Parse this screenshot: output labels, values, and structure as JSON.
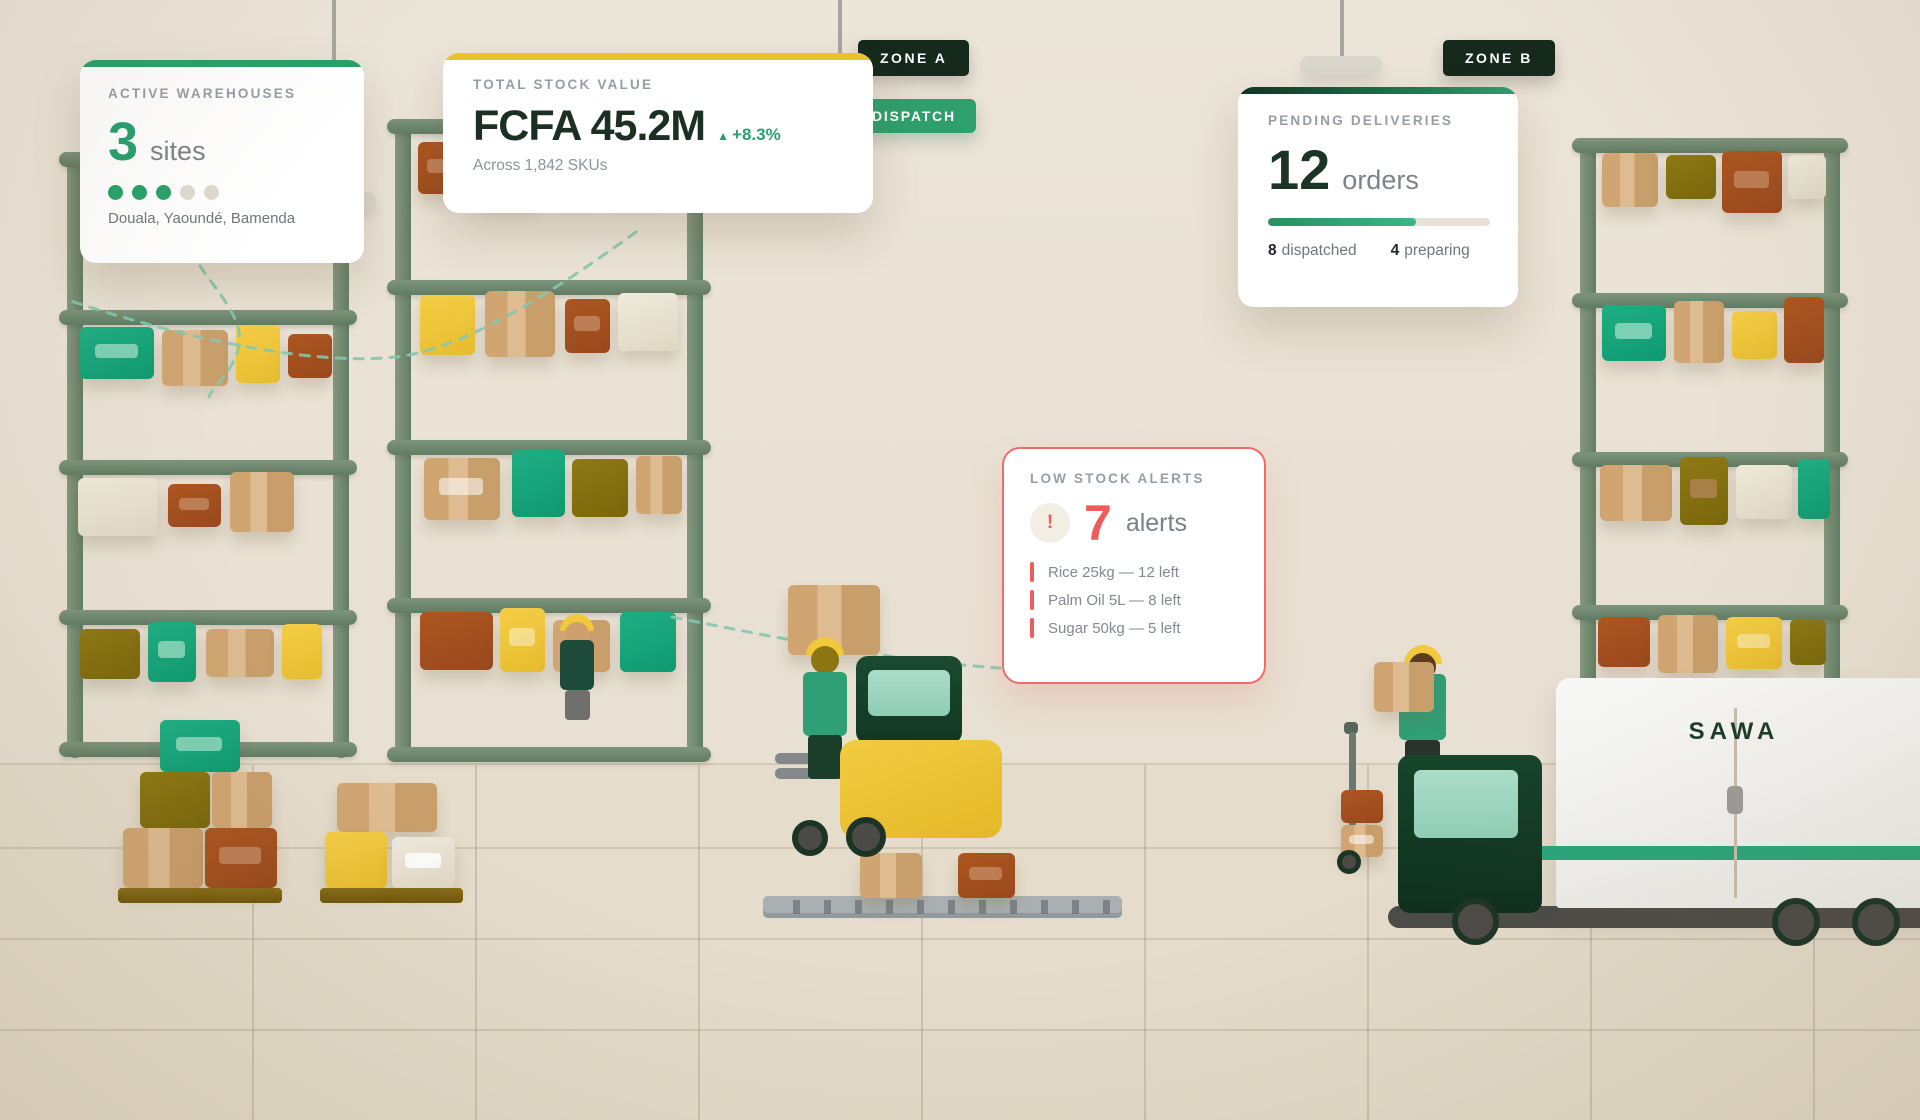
{
  "cards": {
    "active": {
      "title": "ACTIVE WAREHOUSES",
      "value": "3",
      "unit": "sites",
      "dots_filled": 3,
      "dots_total": 5,
      "locations": "Douala, Yaoundé, Bamenda"
    },
    "stock": {
      "title": "TOTAL STOCK VALUE",
      "value": "FCFA 45.2M",
      "delta_icon": "▲",
      "delta": "+8.3%",
      "subtitle": "Across 1,842 SKUs"
    },
    "deliveries": {
      "title": "PENDING DELIVERIES",
      "value": "12",
      "unit": "orders",
      "progress_pct": 66.7,
      "stats": [
        {
          "num": "8",
          "label": "dispatched"
        },
        {
          "num": "4",
          "label": "preparing"
        }
      ]
    },
    "alerts": {
      "title": "LOW STOCK ALERTS",
      "icon": "!",
      "value": "7",
      "unit": "alerts",
      "items": [
        "Rice 25kg — 12 left",
        "Palm Oil 5L — 8 left",
        "Sugar 50kg — 5 left"
      ]
    }
  },
  "badges": {
    "zone_a": "ZONE A",
    "zone_b": "ZONE B",
    "dispatch": "DISPATCH"
  },
  "truck": {
    "brand": "SAWA"
  },
  "colors": {
    "accent_green": "#2aa06b",
    "accent_yellow": "#e9c234",
    "accent_red": "#ee5c5c",
    "dark_green": "#15291c",
    "dot_filled": "#2aa06b",
    "dot_empty": "#dfdacf"
  },
  "scene": {
    "shelves": [
      {
        "x": 67,
        "y": 152,
        "w": 282,
        "h": 606,
        "bars": [
          0,
          158,
          308,
          458,
          590
        ],
        "rows": [
          {
            "y": 175,
            "boxes": [
              [
                "green",
                13,
                0,
                74,
                52,
                1
              ],
              [
                "tan",
                95,
                3,
                66,
                56,
                0
              ],
              [
                "yellow",
                169,
                -2,
                44,
                58,
                0
              ],
              [
                "rust",
                221,
                7,
                44,
                44,
                0
              ]
            ]
          },
          {
            "y": 326,
            "boxes": [
              [
                "cream",
                11,
                0,
                80,
                58,
                0
              ],
              [
                "rust",
                101,
                6,
                53,
                43,
                1
              ],
              [
                "tan",
                163,
                -6,
                64,
                60,
                0
              ]
            ]
          },
          {
            "y": 475,
            "boxes": [
              [
                "olive",
                13,
                2,
                60,
                50,
                0
              ],
              [
                "green",
                81,
                -5,
                48,
                60,
                1
              ],
              [
                "tan",
                139,
                2,
                68,
                48,
                0
              ],
              [
                "yellow",
                215,
                -3,
                40,
                55,
                0
              ]
            ]
          }
        ]
      },
      {
        "x": 395,
        "y": 119,
        "w": 308,
        "h": 641,
        "bars": [
          0,
          161,
          321,
          479,
          628
        ],
        "rows": [
          {
            "y": 23,
            "boxes": [
              [
                "rust",
                23,
                0,
                46,
                52,
                1
              ],
              [
                "tan",
                80,
                2,
                66,
                58,
                0
              ],
              [
                "yellow",
                156,
                0,
                50,
                55,
                0
              ],
              [
                "cream",
                214,
                2,
                56,
                54,
                0
              ]
            ]
          },
          {
            "y": 172,
            "boxes": [
              [
                "yellow",
                25,
                4,
                55,
                60,
                0
              ],
              [
                "tan",
                90,
                0,
                70,
                66,
                0
              ],
              [
                "rust",
                170,
                8,
                45,
                54,
                1
              ],
              [
                "cream",
                223,
                2,
                60,
                58,
                0
              ]
            ]
          },
          {
            "y": 330,
            "boxes": [
              [
                "tan",
                29,
                9,
                76,
                62,
                1
              ],
              [
                "green",
                117,
                1,
                53,
                67,
                0
              ],
              [
                "olive",
                177,
                10,
                56,
                58,
                0
              ],
              [
                "tan",
                241,
                7,
                46,
                58,
                0
              ]
            ]
          },
          {
            "y": 489,
            "boxes": [
              [
                "rust",
                25,
                4,
                73,
                58,
                0
              ],
              [
                "yellow",
                105,
                0,
                45,
                64,
                1
              ],
              [
                "tan",
                158,
                12,
                57,
                52,
                0
              ],
              [
                "green",
                225,
                4,
                56,
                60,
                0
              ]
            ]
          }
        ]
      },
      {
        "x": 1580,
        "y": 138,
        "w": 260,
        "h": 562,
        "bars": [
          0,
          155,
          314,
          467
        ],
        "rows": [
          {
            "y": 15,
            "boxes": [
              [
                "tan",
                22,
                0,
                56,
                54,
                0
              ],
              [
                "olive",
                86,
                2,
                50,
                44,
                0
              ],
              [
                "rust",
                142,
                -2,
                60,
                62,
                1
              ],
              [
                "cream",
                208,
                2,
                38,
                44,
                0
              ]
            ]
          },
          {
            "y": 167,
            "boxes": [
              [
                "green",
                22,
                0,
                64,
                56,
                1
              ],
              [
                "tan",
                94,
                -4,
                50,
                62,
                0
              ],
              [
                "yellow",
                152,
                6,
                45,
                48,
                0
              ],
              [
                "rust",
                204,
                -8,
                40,
                66,
                0
              ]
            ]
          },
          {
            "y": 327,
            "boxes": [
              [
                "tan",
                20,
                0,
                72,
                56,
                0
              ],
              [
                "olive",
                100,
                -8,
                48,
                68,
                1
              ],
              [
                "cream",
                156,
                0,
                56,
                54,
                0
              ],
              [
                "green",
                218,
                -6,
                32,
                60,
                0
              ]
            ]
          },
          {
            "y": 479,
            "boxes": [
              [
                "rust",
                18,
                0,
                52,
                50,
                0
              ],
              [
                "tan",
                78,
                -2,
                60,
                58,
                0
              ],
              [
                "yellow",
                146,
                0,
                56,
                52,
                1
              ],
              [
                "olive",
                210,
                2,
                36,
                46,
                0
              ]
            ]
          }
        ]
      }
    ],
    "loose_boxes": [
      [
        "green",
        160,
        720,
        80,
        52,
        1
      ],
      [
        "olive",
        140,
        772,
        70,
        56,
        0
      ],
      [
        "tan",
        212,
        772,
        60,
        56,
        0
      ],
      [
        "tan",
        123,
        828,
        80,
        60,
        0
      ],
      [
        "rust",
        205,
        828,
        72,
        60,
        1
      ],
      [
        "tan",
        337,
        783,
        100,
        49,
        0
      ],
      [
        "yellow",
        325,
        832,
        62,
        56,
        0
      ],
      [
        "cream",
        392,
        837,
        63,
        51,
        1
      ],
      [
        "tan",
        860,
        853,
        62,
        45,
        0
      ],
      [
        "rust",
        958,
        853,
        57,
        45,
        1
      ]
    ]
  }
}
